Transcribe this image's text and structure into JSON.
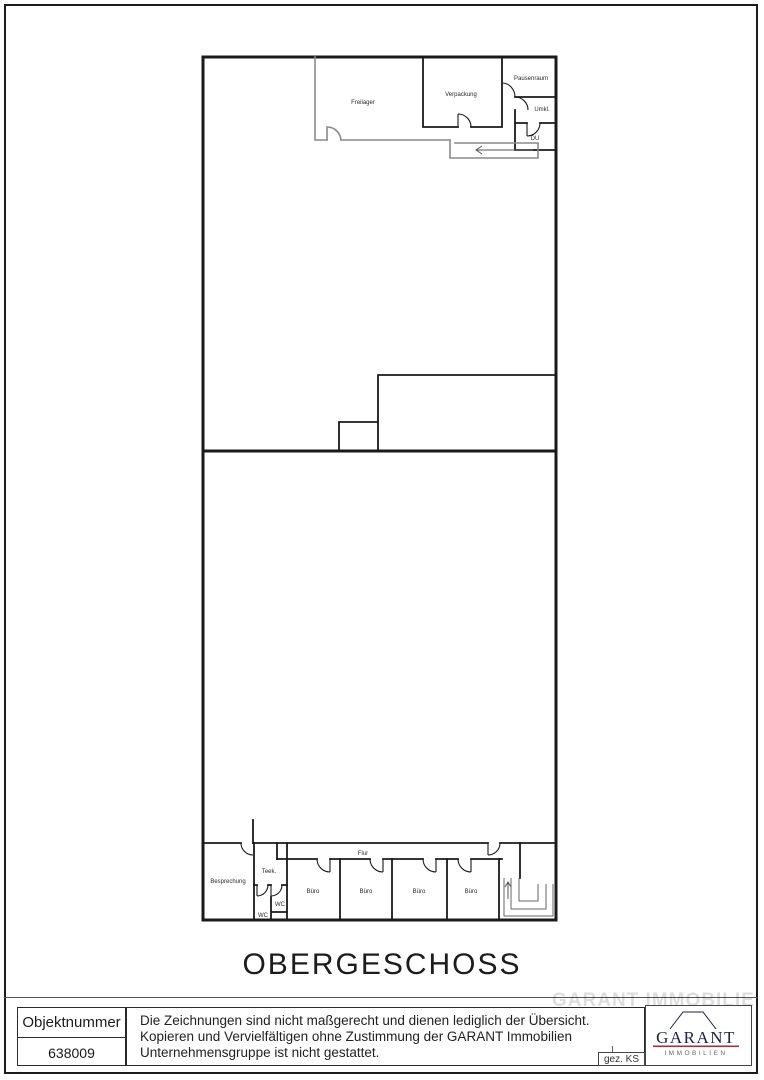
{
  "page": {
    "title": "OBERGESCHOSS"
  },
  "plan": {
    "rooms": [
      {
        "id": "freilager",
        "label": "Freilager",
        "x": 363,
        "y": 104
      },
      {
        "id": "verpackung",
        "label": "Verpackung",
        "x": 461,
        "y": 96
      },
      {
        "id": "pausenraum",
        "label": "Pausenraum",
        "x": 531,
        "y": 80
      },
      {
        "id": "umkl",
        "label": "Umkl.",
        "x": 542,
        "y": 111
      },
      {
        "id": "du",
        "label": "DU",
        "x": 535,
        "y": 140
      },
      {
        "id": "besprechung",
        "label": "Besprechung",
        "x": 228,
        "y": 883
      },
      {
        "id": "teek",
        "label": "Teek.",
        "x": 269,
        "y": 873
      },
      {
        "id": "wc-right",
        "label": "WC",
        "x": 280,
        "y": 906
      },
      {
        "id": "wc-left",
        "label": "WC",
        "x": 263,
        "y": 917
      },
      {
        "id": "buero-1",
        "label": "Büro",
        "x": 313,
        "y": 893
      },
      {
        "id": "buero-2",
        "label": "Büro",
        "x": 366,
        "y": 893
      },
      {
        "id": "buero-3",
        "label": "Büro",
        "x": 419,
        "y": 893
      },
      {
        "id": "buero-4",
        "label": "Büro",
        "x": 471,
        "y": 893
      },
      {
        "id": "flur",
        "label": "Flur",
        "x": 363,
        "y": 855
      }
    ]
  },
  "footer": {
    "object_number_label": "Objektnummer",
    "object_number_value": "638009",
    "disclaimer_lines": [
      "Die Zeichnungen sind nicht maßgerecht und dienen lediglich der Übersicht.",
      "Kopieren und Vervielfältigen ohne Zustimmung der GARANT Immobilien",
      "Unternehmensgruppe ist nicht gestattet."
    ],
    "drawn_by": "gez. KS",
    "logo": {
      "name": "GARANT",
      "subtitle": "IMMOBILIEN"
    },
    "watermark": "GARANT IMMOBILIEN"
  },
  "colors": {
    "wall": "#1a1a1a",
    "light_wall": "#8a8a8a",
    "logo_navy": "#1f2240",
    "logo_rule": "#8a3b45"
  }
}
